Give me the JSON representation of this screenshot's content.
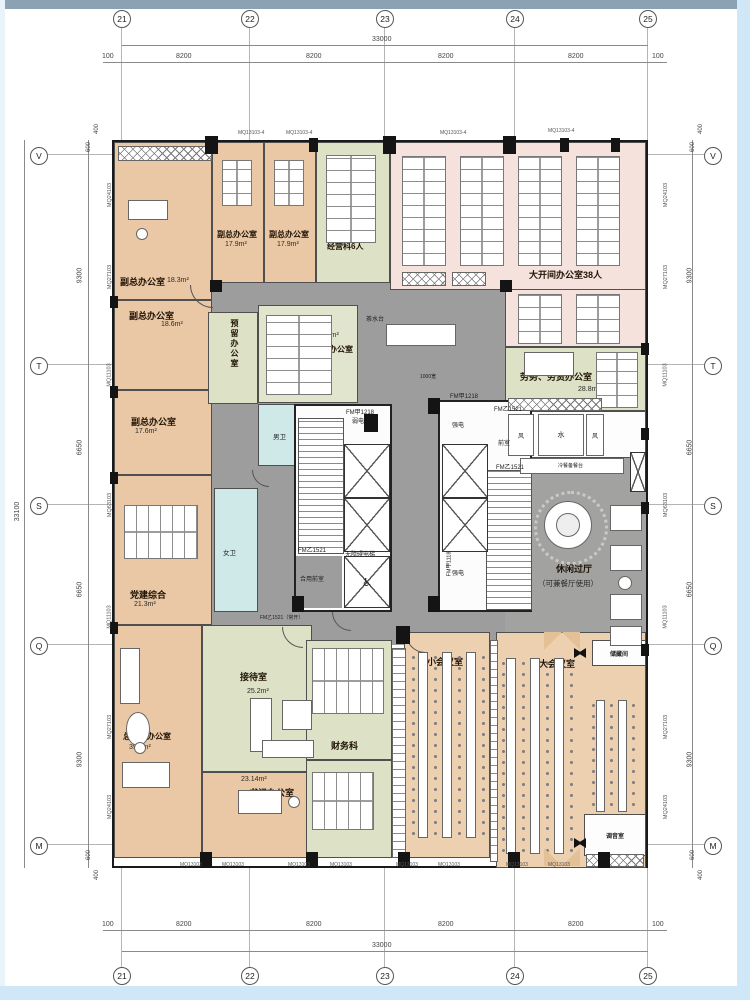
{
  "axes": {
    "top": [
      "21",
      "22",
      "23",
      "24",
      "25"
    ],
    "bottom": [
      "21",
      "22",
      "23",
      "24",
      "25"
    ],
    "left": [
      "V",
      "T",
      "S",
      "Q",
      "M"
    ],
    "right": [
      "V",
      "T",
      "S",
      "Q",
      "M"
    ]
  },
  "dimensions": {
    "top": {
      "total": "33000",
      "edge_left": "100",
      "edge_right": "100",
      "segments": [
        "8200",
        "8200",
        "8200",
        "8200"
      ]
    },
    "bottom": {
      "total": "33000",
      "edge_left": "100",
      "edge_right": "100",
      "segments": [
        "8200",
        "8200",
        "8200",
        "8200"
      ]
    },
    "left": {
      "total": "33100",
      "segments": [
        "9300",
        "6650",
        "6650",
        "9300"
      ],
      "edge_top": [
        "400",
        "600"
      ],
      "edge_bottom": [
        "600",
        "400"
      ]
    },
    "right": {
      "segments": [
        "9300",
        "6650",
        "6650",
        "9300"
      ],
      "edge_top": [
        "400",
        "600"
      ],
      "edge_bottom": [
        "600",
        "400"
      ]
    }
  },
  "wall_labels": {
    "left": [
      "MQ24103",
      "MQ27103",
      "MQ11103",
      "MQ63103",
      "MQ11103",
      "MQ27103",
      "MQ24103"
    ],
    "right": [
      "MQ24103",
      "MQ27103",
      "MQ11103",
      "MQ63103",
      "MQ11103",
      "MQ27103",
      "MQ24103"
    ],
    "top": [
      "MQ13103-4",
      "MQ13103-4",
      "MQ13103-4",
      "MQ13103-4"
    ],
    "bottom": [
      "MQ13103",
      "MQ13103",
      "MQ13103",
      "MQ13103",
      "MQ13103",
      "MQ13103",
      "MQ13103",
      "MQ13103"
    ]
  },
  "rooms": [
    {
      "name": "副总办公室",
      "area": "18.3m²"
    },
    {
      "name": "副总办公室",
      "area": "17.9m²"
    },
    {
      "name": "副总办公室",
      "area": "17.9m²"
    },
    {
      "name": "经营科6人",
      "area": ""
    },
    {
      "name": "大开间办公室38人",
      "area": ""
    },
    {
      "name": "副总办公室",
      "area": "18.6m²"
    },
    {
      "name": "副总办公室",
      "area": "17.6m²"
    },
    {
      "name": "党建综合",
      "area": "21.3m²"
    },
    {
      "name": "预留办公室",
      "area": ""
    },
    {
      "name": "商务办公室",
      "area": "20.5m²"
    },
    {
      "name": "劳务、劳资办公室",
      "area": "28.8m²"
    },
    {
      "name": "休闲过厅",
      "sub": "（可兼餐厅使用）"
    },
    {
      "name": "总经理办公室",
      "area": "39.6m²"
    },
    {
      "name": "接待室",
      "area": "25.2m²"
    },
    {
      "name": "书记办公室",
      "area": "23.14m²"
    },
    {
      "name": "财务科",
      "area": "26.9m²"
    },
    {
      "name": "出纳",
      "area": ""
    },
    {
      "name": "小会议室",
      "area": ""
    },
    {
      "name": "大会议室",
      "area": ""
    },
    {
      "name": "储藏间",
      "area": ""
    },
    {
      "name": "调音室",
      "area": ""
    },
    {
      "name": "男卫"
    },
    {
      "name": "女卫"
    }
  ],
  "annotations": [
    {
      "text": "FM甲1218"
    },
    {
      "text": "弱电"
    },
    {
      "text": "FM甲1218"
    },
    {
      "text": "强电"
    },
    {
      "text": "前室"
    },
    {
      "text": "FM乙1521"
    },
    {
      "text": "FM乙1521"
    },
    {
      "text": "FM乙1521"
    },
    {
      "text": "无障碍电梯"
    },
    {
      "text": "合用前室"
    },
    {
      "text": "强电"
    },
    {
      "text": "FM甲1118"
    },
    {
      "text": "FM乙1521（常开）"
    },
    {
      "text": "茶水台"
    },
    {
      "text": "1000宽"
    },
    {
      "text": "水"
    },
    {
      "text": "风"
    },
    {
      "text": "风"
    },
    {
      "text": "冷餐备餐台"
    }
  ],
  "colors": {
    "office_peach": "#eac8a5",
    "office_green": "#dde1c5",
    "open_office_pink": "#f5e2dc",
    "corridor_gray": "#9d9d9d",
    "toilet_blue": "#cfe9e9",
    "wall_black": "#1a1a1a",
    "frame_top": "#8ca1b2",
    "frame_edge": "#cfe7f6"
  }
}
